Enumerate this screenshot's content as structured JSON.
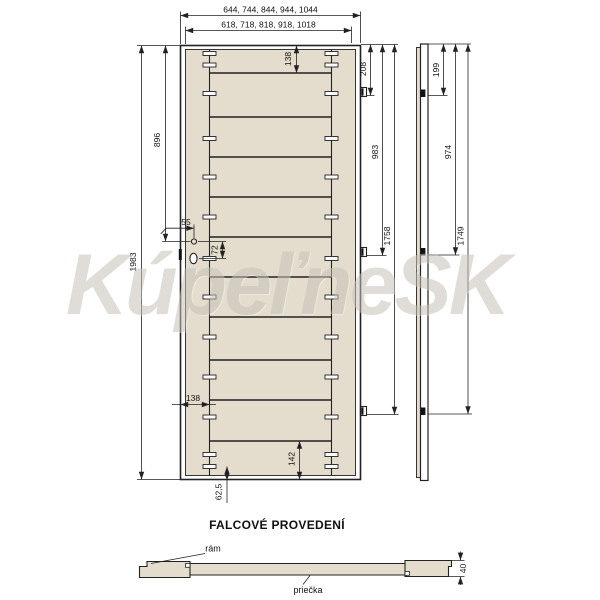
{
  "watermark": "KúpeľneSK",
  "title": "FALCOVÉ PROVEDENÍ",
  "labels": {
    "frame": "rám",
    "crossbar": "priečka"
  },
  "dimensions": {
    "outer_widths": "644, 744, 844, 944, 1044",
    "inner_widths": "618, 718, 818, 918, 1018",
    "door_height": "1983",
    "lock_center_from_top": "896",
    "lock_backset": "55",
    "lock_spacing": "72",
    "top_rail": "138",
    "stile_width": "138",
    "bottom_rail": "142",
    "bottom_tenon_offset": "62,5",
    "hinge1_front": "208",
    "hinge2_front": "983",
    "hinge3_front": "1758",
    "hinge1_side": "199",
    "hinge2_side": "974",
    "hinge3_side": "1749",
    "door_thickness": "40"
  },
  "colors": {
    "wood": "#e4ddcd",
    "line": "#222222",
    "wm": "#c7c1b8"
  }
}
